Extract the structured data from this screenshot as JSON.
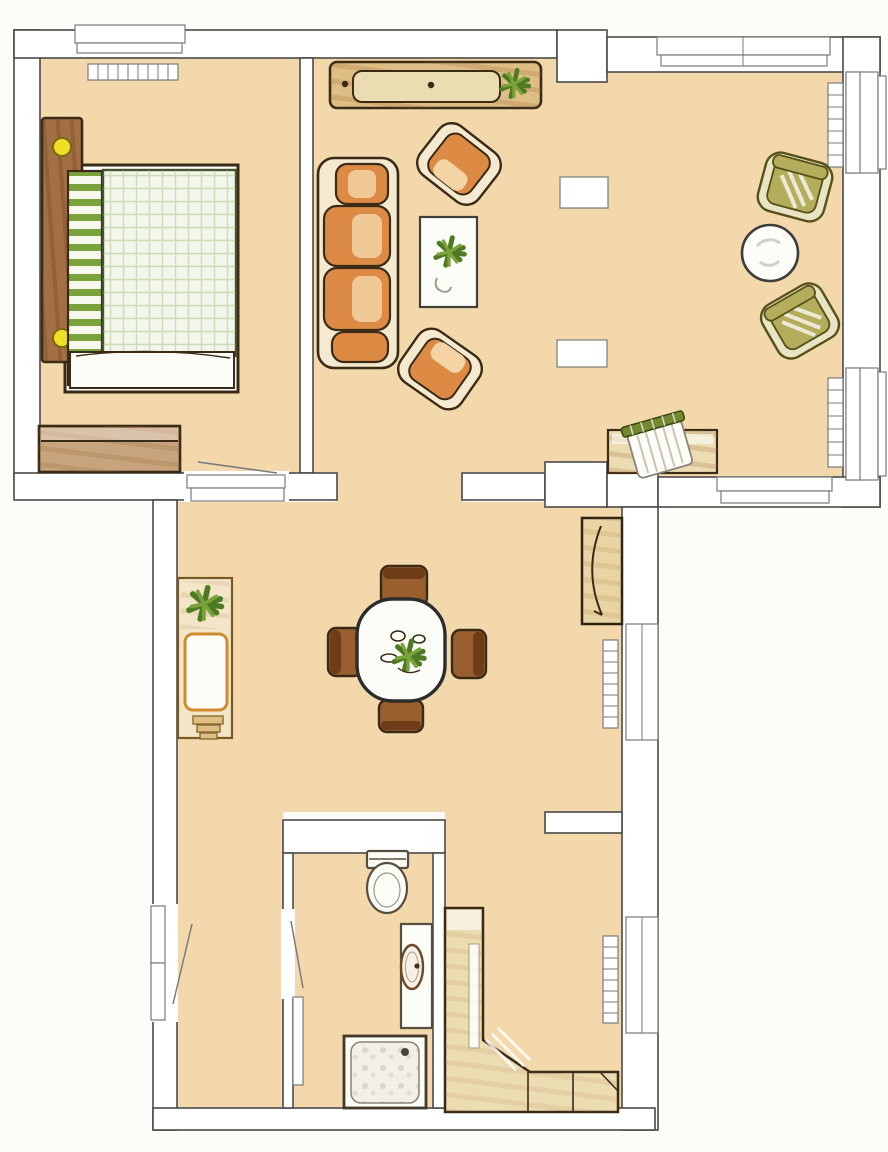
{
  "palette": {
    "bg": "#fdfcf9",
    "wall-fill": "#ffffff",
    "line": "#4a4a4a",
    "line-soft": "#7a7a7a",
    "floor": "#f2d8ab",
    "ink": "#3a2a16",
    "wood": "#a36f45",
    "wood-light": "#c7a47e",
    "orange": "#dd8a45",
    "orange-light": "#f4d3a4",
    "cream": "#f5e9cf",
    "olive": "#b4ad5c",
    "olive-shell": "#e8e4c4",
    "olive-dark": "#575019",
    "green": "#7aa33c",
    "green-dark": "#4e7a22",
    "yellow": "#f0df25",
    "tan": "#ecdcb2",
    "tan-deep": "#dfbe86",
    "white-fix": "#fdfdf8",
    "brown-chair": "#9a5f2f",
    "brown-chair-dark": "#6e3c16"
  },
  "plan": {
    "type": "apartment-floor-plan",
    "style": "hand-drawn colored-pencil scan, top view, no text labels",
    "rooms": [
      {
        "id": "bedroom",
        "furniture": [
          "double-bed",
          "rolled-blanket",
          "headboard-with-knobs",
          "dresser",
          "radiator",
          "window",
          "door-to-hall"
        ]
      },
      {
        "id": "living-room",
        "furniture": [
          "sideboard-with-plant",
          "three-seat-sofa",
          "armchair",
          "armchair",
          "coffee-table-with-plant",
          "lounge-chair",
          "lounge-chair",
          "round-side-table",
          "desk",
          "desk-chair",
          "column",
          "column",
          "radiator",
          "radiator",
          "window-top",
          "window-right-upper",
          "window-right-lower",
          "window-bottom"
        ]
      },
      {
        "id": "hall-dining",
        "furniture": [
          "plant-cabinet",
          "dining-table",
          "dining-chair",
          "dining-chair",
          "dining-chair",
          "dining-chair",
          "table-centerpiece",
          "display-cabinet",
          "radiator",
          "radiator",
          "window",
          "window",
          "entrance-door"
        ]
      },
      {
        "id": "bathroom",
        "furniture": [
          "toilet",
          "washbasin-counter",
          "shower-tray",
          "bathroom-door"
        ]
      },
      {
        "id": "lower-hall",
        "furniture": [
          "corner-closet"
        ]
      }
    ],
    "counts": {
      "windows": 7,
      "radiators": 5,
      "doors": 3,
      "columns": 2
    }
  }
}
